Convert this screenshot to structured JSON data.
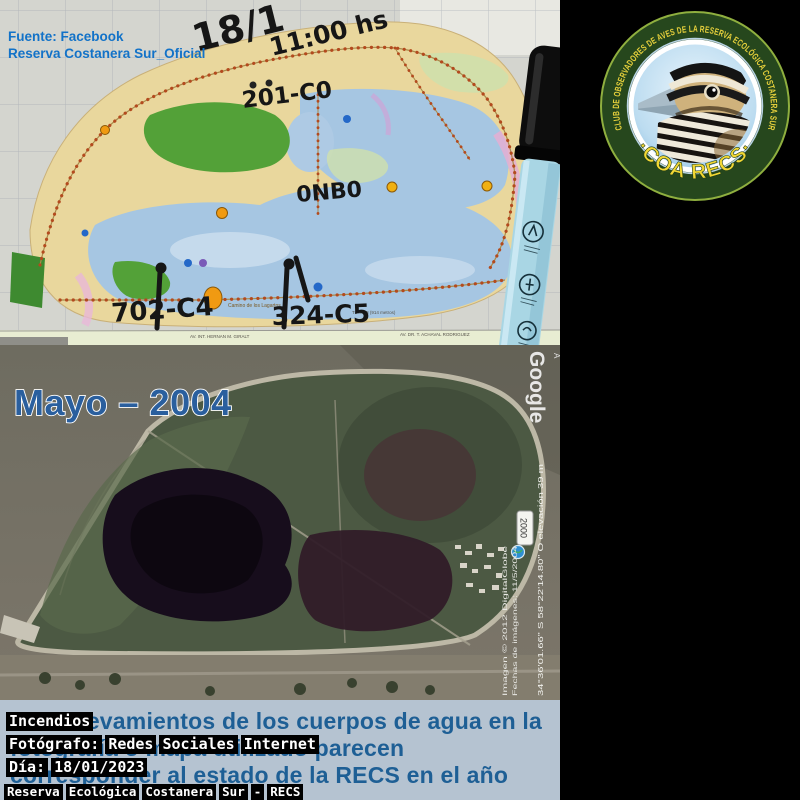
{
  "collage": {
    "map": {
      "source_line1": "Fuente: Facebook",
      "source_line2": "Reserva Costanera Sur_Oficial",
      "handwritten": {
        "date": "18/1",
        "time": "11:00 hs",
        "code_top": "201-C0",
        "code_mid": "0NB0",
        "code_left": "702-C4",
        "code_right": "324-C5"
      },
      "street1": "AV. INT. HERNAN M. GIRALT",
      "street2": "AV. DR. T. ACHAVAL RODRIGUEZ",
      "trail_label": "Camino de los Lagartos",
      "tramo_label": "Tramo 8 (914 metros)"
    },
    "logo": {
      "ring_text": "CLUB DE OBSERVADORES DE AVES DE LA RESERVA ECOLÓGICA COSTANERA SUR",
      "name": "·COA RECS·"
    },
    "satellite": {
      "title": "Mayo – 2004",
      "watermark": "Google",
      "corner_letter": "A",
      "year_chip": "2000",
      "credit1": "Imagen © 2012 DigitalGlobe",
      "credit2": "Fechas de imágenes: 11/5/2004",
      "coordinates": "34°36'01.66\" S  58°22'14.80\" O   elevación   39 m"
    },
    "caption": {
      "line1": "Los relevamientos de los cuerpos de agua en la",
      "line2": "fotografía o mapa utilizado parecen",
      "line3": "corresponder al estado de la RECS en el año 2004."
    },
    "tags": {
      "event": "Incendios",
      "photographer": "Fotógrafo: Redes Sociales Internet",
      "date": "Día: 18/01/2023",
      "site": "Reserva Ecológica Costanera Sur - RECS"
    },
    "colors": {
      "caption_bg": "#b5c3d1",
      "caption_text": "#1e5f95",
      "source_text": "#1272c8",
      "logo_green": "#26471d",
      "logo_yellow": "#f2d735",
      "lagoon_blue": "#a6c6e2",
      "land_cream": "#e9d79d"
    }
  }
}
